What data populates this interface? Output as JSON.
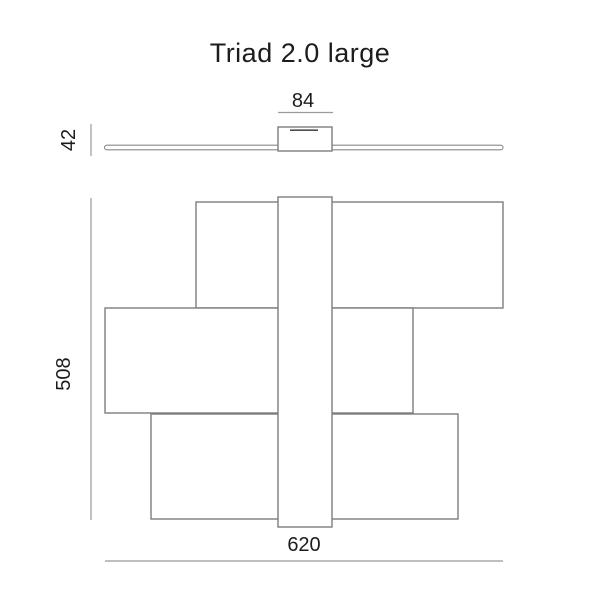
{
  "title": "Triad 2.0 large",
  "dims": {
    "canopy_width": "84",
    "profile_height": "42",
    "overall_height": "508",
    "overall_width": "620"
  },
  "views": {
    "top_profile_view": {
      "description": "side profile of ceiling mount bar with canopy box",
      "dimensions_shown": [
        "84",
        "42"
      ]
    },
    "front_view": {
      "description": "three stacked offset rectangular panels crossed by vertical center bar",
      "dimensions_shown": [
        "508",
        "620"
      ]
    }
  },
  "colors": {
    "background": "#ffffff",
    "panel_stroke": "#7d7d7d",
    "dimension_line": "#9a9a9a",
    "text": "#1c1c1c"
  }
}
